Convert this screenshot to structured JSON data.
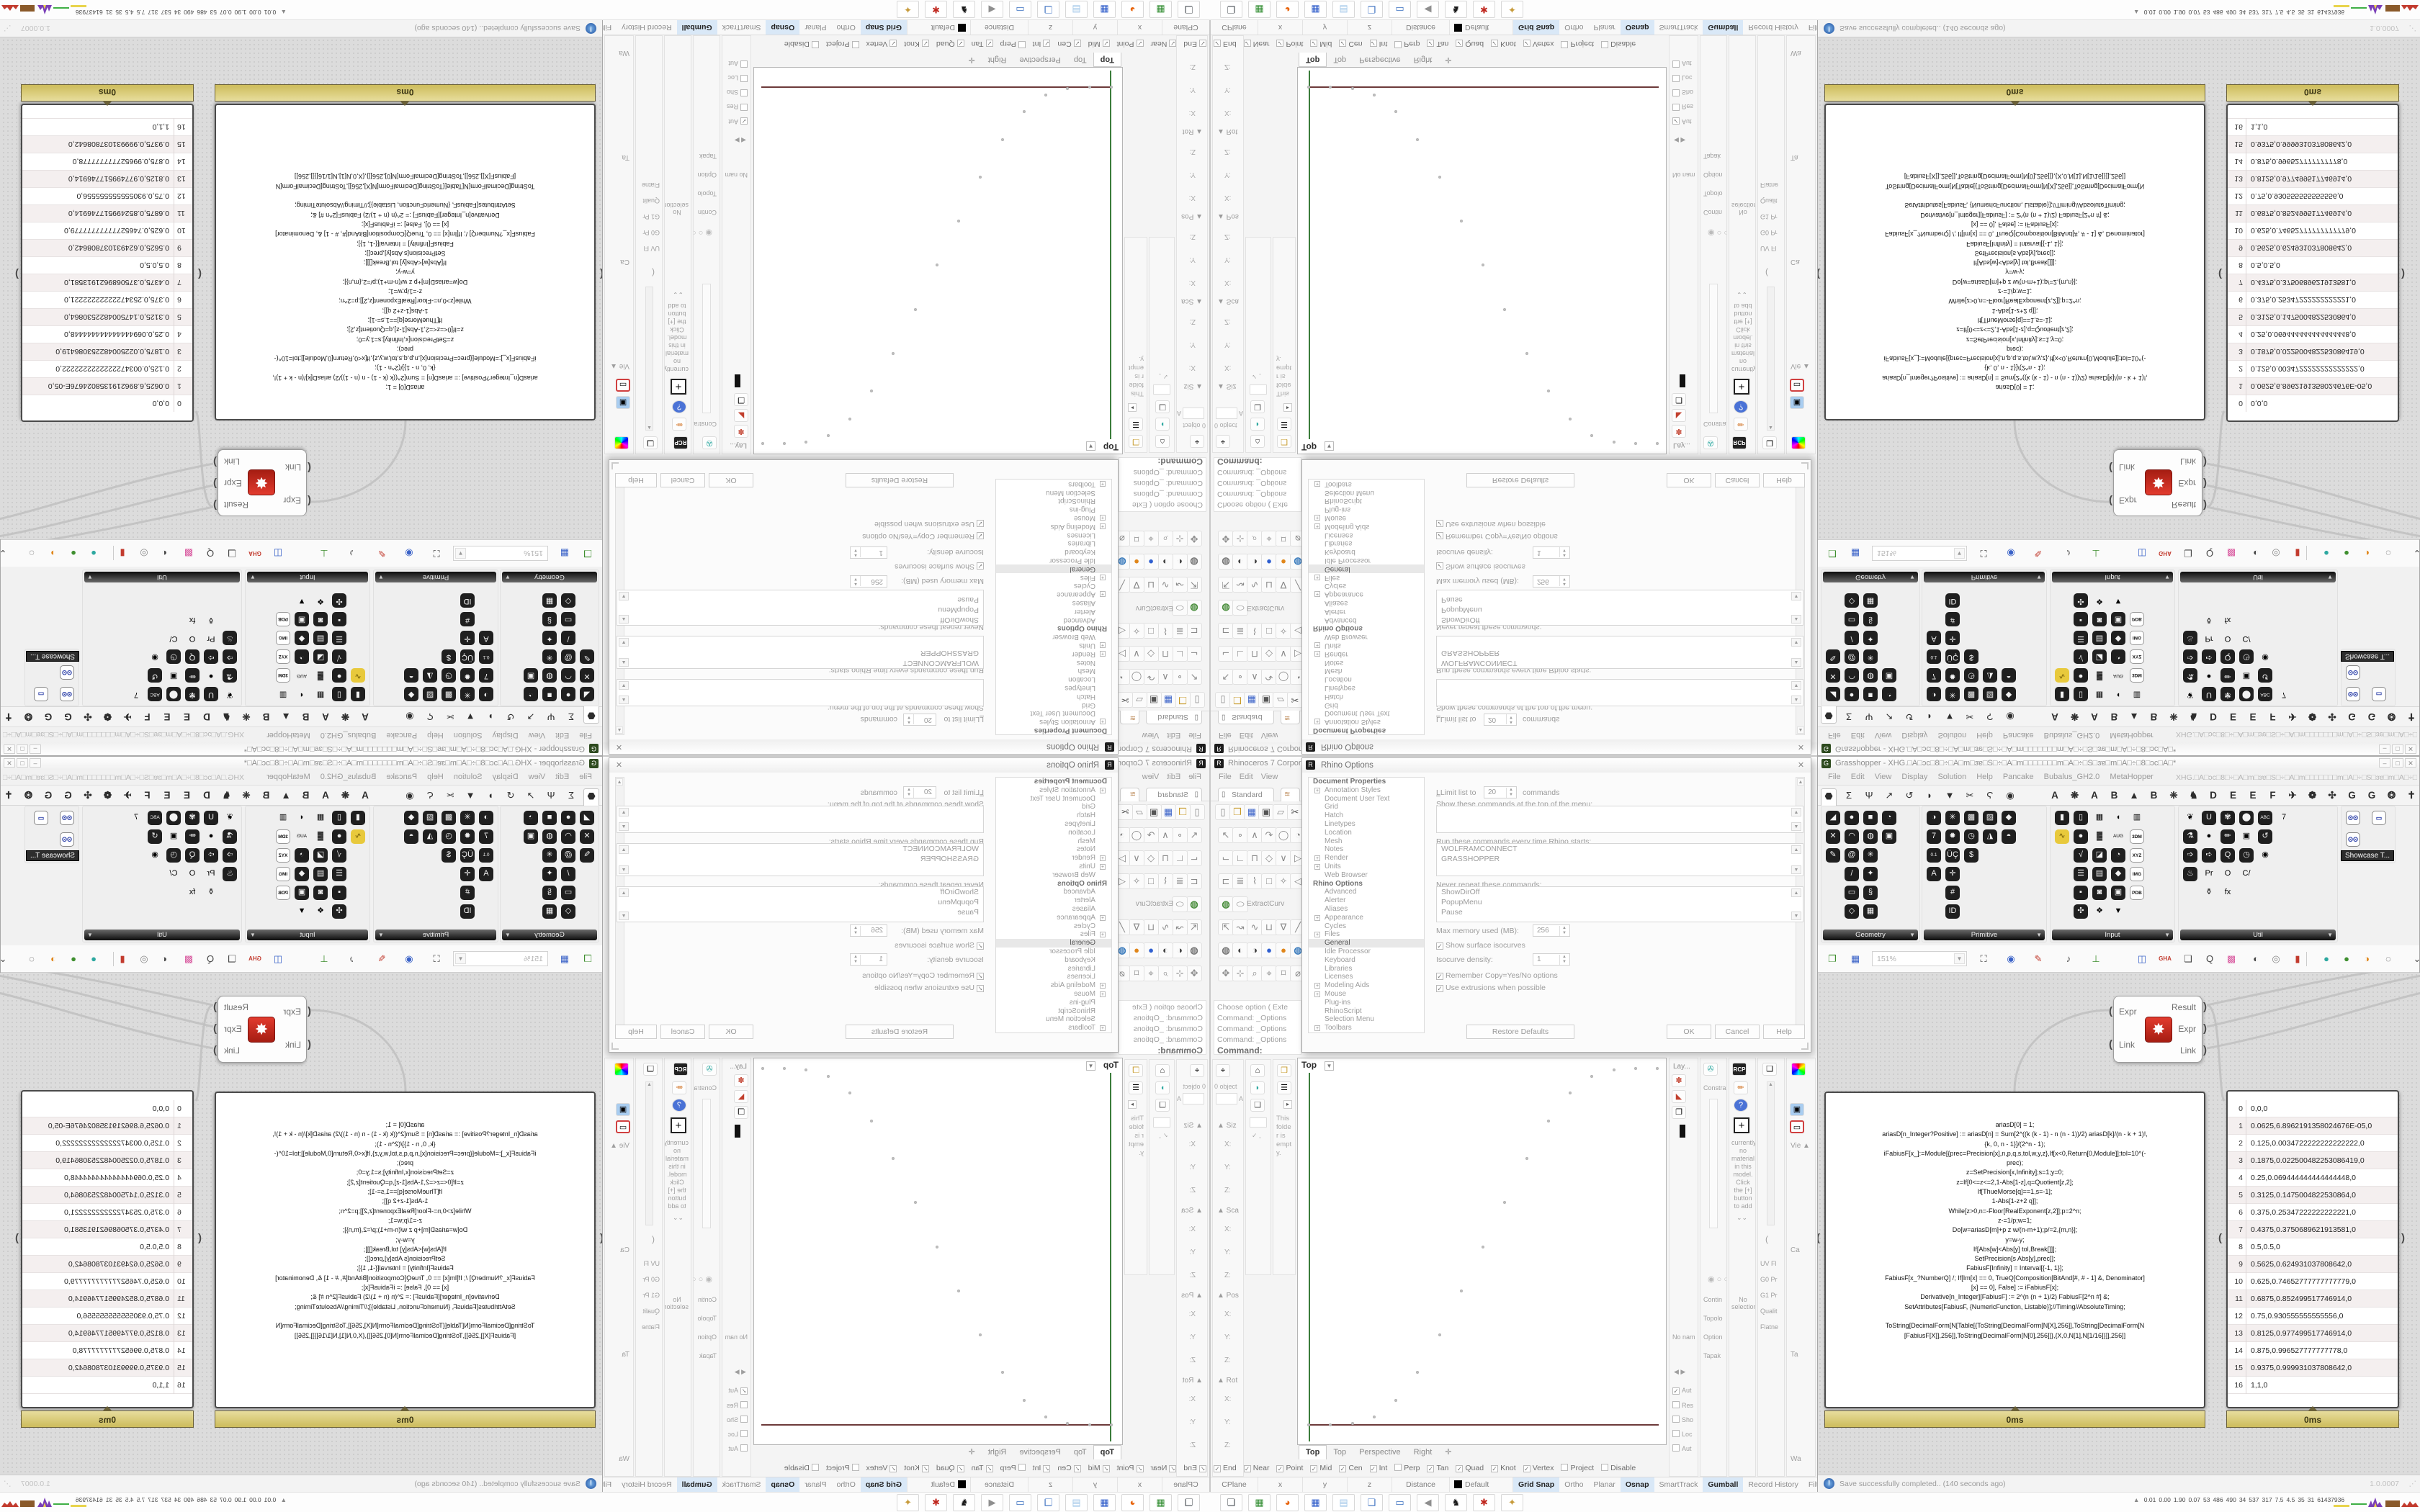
{
  "rhino": {
    "title": "Rhinoceros 7 Corporate -",
    "menus": [
      "File",
      "Edit",
      "View",
      "Curve"
    ],
    "toolbar_tab": "Standard",
    "file_icons": [
      "▯|w",
      "❒|y",
      "▦|b",
      "▣|k",
      "▱|w",
      "✂|k"
    ],
    "sidebar_rows": [
      [
        "↖",
        "∘",
        "∧",
        "↷",
        "◯",
        "◔"
      ],
      [
        "⌙",
        "∟",
        "⊓",
        "◇",
        "∨",
        "▷"
      ],
      [
        "⊏",
        "≣",
        "⌇",
        "□",
        "✧",
        "◁"
      ],
      [
        "◍|#4c8f3f",
        "⬭",
        "ExtractCurv|label"
      ],
      [
        "⇱",
        "↝",
        "∿",
        "⊔",
        "∇",
        "╱"
      ],
      [
        "◍|#7a7a7a",
        "◐|#444444",
        "◑|#444444",
        "●|#2f5fd0",
        "●|#e0861a",
        "◍|#3f7fbf"
      ],
      [
        "✥",
        "⊹",
        "⌕",
        "⌖",
        "⌑",
        "⌀"
      ]
    ],
    "command_lines": [
      "Choose option ( Exte",
      "Command: _Options",
      "Command: _Options",
      "Command: _Options"
    ],
    "command_prompt": "Command:",
    "left_dock": {
      "objects_label": "0 object",
      "field_letter": "A",
      "sections": [
        "Siz",
        "Sca",
        "Pos",
        "Rot"
      ],
      "axes": [
        "X:",
        "Y:",
        "Z:"
      ],
      "folder_note_lines": [
        "This",
        "folde",
        "r is",
        "empt",
        "y."
      ],
      "check_mark": "✓"
    },
    "viewport": {
      "label": "Top",
      "tabs": [
        "Top",
        "Top",
        "Perspective",
        "Right"
      ],
      "new_tab_icon": "✛"
    },
    "osnap": [
      [
        "End",
        1
      ],
      [
        "Near",
        1
      ],
      [
        "Point",
        1
      ],
      [
        "Mid",
        1
      ],
      [
        "Cen",
        1
      ],
      [
        "Int",
        1
      ],
      [
        "Perp",
        0
      ],
      [
        "Tan",
        1
      ],
      [
        "Quad",
        1
      ],
      [
        "Knot",
        1
      ],
      [
        "Vertex",
        1
      ],
      [
        "Project",
        0
      ],
      [
        "Disable",
        0
      ]
    ],
    "statusbar": {
      "cells": [
        "CPlane",
        "x",
        "y",
        "z",
        "Distance"
      ],
      "layer_cell": "Default",
      "toggles": [
        [
          "Grid Snap",
          1
        ],
        [
          "Ortho",
          0
        ],
        [
          "Planar",
          0
        ],
        [
          "Osnap",
          1
        ],
        [
          "SmartTrack",
          0
        ],
        [
          "Gumball",
          1
        ],
        [
          "Record History",
          0
        ],
        [
          "Filter",
          0
        ]
      ]
    },
    "right_dock": {
      "layers_tab": "Lay...",
      "constraints_tab": "Constra",
      "rcp_label": "RCP",
      "material_text": "currently no material in this model. Click the [+] button to add",
      "no_selection": "No selection",
      "no_name": "No nam",
      "props_rows": [
        "Vie",
        "Ca",
        "Ta",
        "Wa"
      ],
      "con_rows": [
        "Contin",
        "Topolo",
        "Option",
        "Tapak"
      ],
      "mon_rows": [
        "UV Fl",
        "G0 Pr",
        "G1 Pr",
        "Qualit",
        "Flatne"
      ],
      "checks": [
        [
          "Aut",
          1
        ],
        [
          "Res",
          0
        ],
        [
          "Sho",
          0
        ],
        [
          "Loc",
          0
        ],
        [
          "Aut",
          0
        ]
      ]
    }
  },
  "dialog": {
    "title": "Rhino Options",
    "tree": [
      [
        "h",
        "Document Properties"
      ],
      [
        "e",
        "Annotation Styles"
      ],
      [
        "i",
        "Document User Text"
      ],
      [
        "i",
        "Grid"
      ],
      [
        "i",
        "Hatch"
      ],
      [
        "i",
        "Linetypes"
      ],
      [
        "i",
        "Location"
      ],
      [
        "i",
        "Mesh"
      ],
      [
        "i",
        "Notes"
      ],
      [
        "e",
        "Render"
      ],
      [
        "e",
        "Units"
      ],
      [
        "i",
        "Web Browser"
      ],
      [
        "h",
        "Rhino Options"
      ],
      [
        "i",
        "Advanced"
      ],
      [
        "i",
        "Alerter"
      ],
      [
        "i",
        "Aliases"
      ],
      [
        "e",
        "Appearance"
      ],
      [
        "i",
        "Cycles"
      ],
      [
        "e",
        "Files"
      ],
      [
        "s",
        "General"
      ],
      [
        "i",
        "Idle Processor"
      ],
      [
        "i",
        "Keyboard"
      ],
      [
        "i",
        "Libraries"
      ],
      [
        "i",
        "Licenses"
      ],
      [
        "e",
        "Modeling Aids"
      ],
      [
        "e",
        "Mouse"
      ],
      [
        "i",
        "Plug-ins"
      ],
      [
        "i",
        "RhinoScript"
      ],
      [
        "i",
        "Selection Menu"
      ],
      [
        "e",
        "Toolbars"
      ]
    ],
    "limit_label": "Limit list to",
    "limit_value": "20",
    "limit_suffix": "commands",
    "show_top_label": "Show these commands at the top of the menu:",
    "run_label": "Run these commands every time Rhino starts:",
    "run_items": [
      "WOLFRAMCONNECT",
      "GRASSHOPPER"
    ],
    "never_label": "Never repeat these commands:",
    "never_items": [
      "ShowDirOff",
      "PopupMenu",
      "Pause"
    ],
    "mem_label": "Max memory used (MB):",
    "mem_value": "256",
    "iso_check": "Show surface isocurves",
    "iso_density_label": "Isocurve density:",
    "iso_density_value": "1",
    "remember_check": "Remember Copy=Yes/No options",
    "extrusions_check": "Use extrusions when possible",
    "buttons": [
      "Restore Defaults",
      "OK",
      "Cancel",
      "Help"
    ],
    "close_glyph": "✕"
  },
  "grasshopper": {
    "title": "Grasshopper - XHG.□A□ɔc□8□÷□A□m□ɜɐ□S□÷□A□m□□□□□□□m□A□÷□S□ɜɐ□m□A□÷□8□ɔc□A□*",
    "menus": [
      "File",
      "Edit",
      "View",
      "Display",
      "Solution",
      "Help",
      "Pancake",
      "Bubalus_GH2.0",
      "MetaHopper"
    ],
    "doc_selector": "XHG.□A□ɔc□8□÷□A□m□ɜɐ□S□÷□A□m□□□□□□□m□A□÷□S□ɜɐ□m□A□÷□8□ɔc□A□",
    "window_controls": [
      "–",
      "□",
      "✕"
    ],
    "tab_icons": [
      "⬣|sel",
      "Σ",
      "Ψ",
      "↗",
      "↺",
      "◗",
      "▼",
      "✂",
      "Ϛ",
      "◉"
    ],
    "tab_letters": [
      "A",
      "❋",
      "A",
      "B",
      "▲",
      "B",
      "❈",
      "♞",
      "D",
      "E",
      "E",
      "F",
      "✈",
      "❁",
      "✣",
      "G",
      "G",
      "❂",
      "✝"
    ],
    "palettes": [
      {
        "name": "Geometry",
        "cols": [
          [
            "◢|k",
            "✕|k",
            "✎|k"
          ],
          [
            "●|k",
            "◠|k",
            "@|k",
            "/|k",
            "▭|k",
            "◇|k"
          ],
          [
            "■|k",
            "◍|k",
            "✳|k",
            "✦|k",
            "§|k",
            "▦|k"
          ],
          [
            "◔|k",
            "▣|k"
          ]
        ]
      },
      {
        "name": "Primitive",
        "cols": [
          [
            "◑|k",
            "7|k",
            "0.1|k",
            "A|k"
          ],
          [
            "✳|k",
            "✹|k",
            "ÜÇ|k",
            "✛|k",
            "#|k",
            "ID|k"
          ],
          [
            "▩|k",
            "◷|k",
            "$|k"
          ],
          [
            "▨|k",
            "◮|k"
          ],
          [
            "◆|k",
            "◓|k"
          ]
        ]
      },
      {
        "name": "Input",
        "cols": [
          [
            "▮|k",
            "∿|y"
          ],
          [
            "▯|k",
            "●|k",
            "√|k",
            "☰|k",
            "▪|k",
            "✣|k"
          ],
          [
            "▦|pm",
            "▓|pgc",
            "◪|k",
            "▤|k",
            "◙|k",
            "❖|po"
          ],
          [
            "◖|po",
            "AUG 20|pc",
            "◔|k",
            "◆|k",
            "▣|k",
            "▼|po"
          ],
          [
            "▥|prb",
            "3DM|w",
            "XYZ|w",
            "IMG|w",
            "PDB|w"
          ]
        ]
      },
      {
        "name": "Util",
        "cols": [
          [
            "❦|pr",
            "⚗|k",
            "➩|k",
            "♨|k"
          ],
          [
            "U|k",
            "●|po",
            "➪|k",
            "Pr|pu",
            "⚱|pm"
          ],
          [
            "✾|k",
            "✏|k",
            "Q|k",
            "O|pu",
            "fx|pm"
          ],
          [
            "⬤|k",
            "▣|pb",
            "◷|k",
            "C/|pu"
          ],
          [
            "ABC|k",
            "↺|k",
            "◉|pu"
          ],
          [
            "7|pu"
          ]
        ]
      }
    ],
    "showcase_icons": [
      "ʘʘ|w",
      "▭|k",
      "ʘʘ|w"
    ],
    "showcase_tooltip": "Showcase T...",
    "toolbar": {
      "zoom": "151%",
      "icons": [
        "❐|g",
        "▦|b",
        "",
        "⛶|k",
        "◉|b",
        "✎|r",
        "♪|k",
        "⊥|g",
        "◫|b",
        "GHA|r",
        "❏|k",
        "Q|k",
        "▩|pm",
        "◐|k",
        "◎|w",
        "▮|r",
        "|",
        "●|t",
        "●|g",
        "◑|o",
        "◌|k",
        "⌄|k"
      ]
    },
    "component": {
      "inputs": [
        "Expr",
        "Link"
      ],
      "outputs": [
        "Result",
        "Expr",
        "Link"
      ],
      "icon": "✸",
      "time": "5ms"
    },
    "code_panel": {
      "time": "0ms",
      "lines": [
        "ariasD[0] = 1;",
        "ariasD[n_Integer?Positive] := ariasD[n] = Sum[2^((k (k - 1) - n (n - 1))/2) ariasD[k]/(n - k + 1)!,",
        "{k, 0, n - 1}]/(2^n - 1);",
        "iFabiusF[x_]:=Module[{prec=Precision[x],n,p,q,s,tol,w,y,z},If[x<0,Return[0,Module]];tol=10^(-",
        "prec);",
        "z=SetPrecision[x,Infinity];s=1;y=0;",
        "z=If[0<=z<=2,1-Abs[1-z],q=Quotient[z,2];",
        "If[ThueMorse[q]==1,s=-1];",
        "1-Abs[1-z+2 q]];",
        "While[z>0,n=-Floor[RealExponent[z,2]];p=2^n;",
        "z-=1/p;w=1;",
        "Do[w=ariasD[m]+p z w/(n-m+1);p/=2,{m,n}];",
        "y=w-y;",
        "If[Abs[w]<Abs[y] tol,Break[]]];",
        "SetPrecision[s Abs[y],prec]];",
        "FabiusF[Infinity] = Interval[{-1, 1}];",
        "FabiusF[x_?NumberQ] /; If[Im[x] == 0, TrueQ[Composition[BitAnd[#, # - 1] &, Denominator]",
        "[x] == 0], False] := iFabiusF[x];",
        "Derivative[n_Integer][FabiusF] := 2^(n (n + 1)/2) FabiusF[2^n #] &;",
        "SetAttributes[FabiusF, {NumericFunction, Listable}];//Timing//AbsoluteTiming;",
        "",
        "ToString[DecimalForm[N[Table[{ToString[DecimalForm[N[X],256]],ToString[DecimalForm[N",
        "[FabiusF[X]],256]],ToString[DecimalForm[N[0],256]]},{X,0,N[1],N[1/16]}]],256]]"
      ]
    },
    "table_panel": {
      "time": "0ms",
      "rows": [
        "0,0,0",
        "0.0625,6.8962191358024676E-05,0",
        "0.125,0.0034722222222222222,0",
        "0.1875,0.022500482253086419,0",
        "0.25,0.069444444444444448,0",
        "0.3125,0.1475004822530864,0",
        "0.375,0.25347222222222221,0",
        "0.4375,0.3750689621913581,0",
        "0.5,0.5,0",
        "0.5625,0.624931037808642,0",
        "0.625,0.74652777777777779,0",
        "0.6875,0.852499517746914,0",
        "0.75,0.930555555555556,0",
        "0.8125,0.977499517746914,0",
        "0.875,0.996527777777778,0",
        "0.9375,0.999931037808642,0",
        "1,1,0"
      ]
    },
    "statusbar": {
      "message": "Save successfully completed.. (140 seconds ago)",
      "version": "1.0.0007"
    }
  },
  "taskbar": {
    "icons": [
      "❏|#4a4f55",
      "▦|#2e8b2e",
      "◕|#e8650d",
      "▦|#2857c8",
      "▤|#9fc6e8",
      "❏|#3a6fc0",
      "▭|#3a6fc0",
      "◀|#8f8f8f",
      "♞|#1a1a1a",
      "✱|#c0271e",
      "✦|#c79b3b"
    ]
  },
  "monitor": {
    "icon": "▲",
    "values": [
      "0.01",
      "0.00",
      "1.90",
      "0.07",
      "53",
      "486",
      "490",
      "34",
      "537",
      "317",
      "7.5",
      "4.5",
      "35",
      "31",
      "61437936"
    ]
  },
  "chart_data": {
    "type": "scatter",
    "title": "Fabius function samples in Rhino Top viewport",
    "x": [
      0,
      0.0625,
      0.125,
      0.1875,
      0.25,
      0.3125,
      0.375,
      0.4375,
      0.5,
      0.5625,
      0.625,
      0.6875,
      0.75,
      0.8125,
      0.875,
      0.9375,
      1
    ],
    "y": [
      0,
      6.89621913580247e-05,
      0.003472222222222222,
      0.02250048225308642,
      0.06944444444444445,
      0.1475004822530864,
      0.2534722222222222,
      0.3750689621913581,
      0.5,
      0.624931037808642,
      0.7465277777777778,
      0.852499517746914,
      0.930555555555556,
      0.977499517746914,
      0.996527777777778,
      0.999931037808642,
      1
    ],
    "xlabel": "",
    "ylabel": "",
    "xlim": [
      0,
      1
    ],
    "ylim": [
      0,
      1
    ],
    "grid": false,
    "legend": "none"
  }
}
